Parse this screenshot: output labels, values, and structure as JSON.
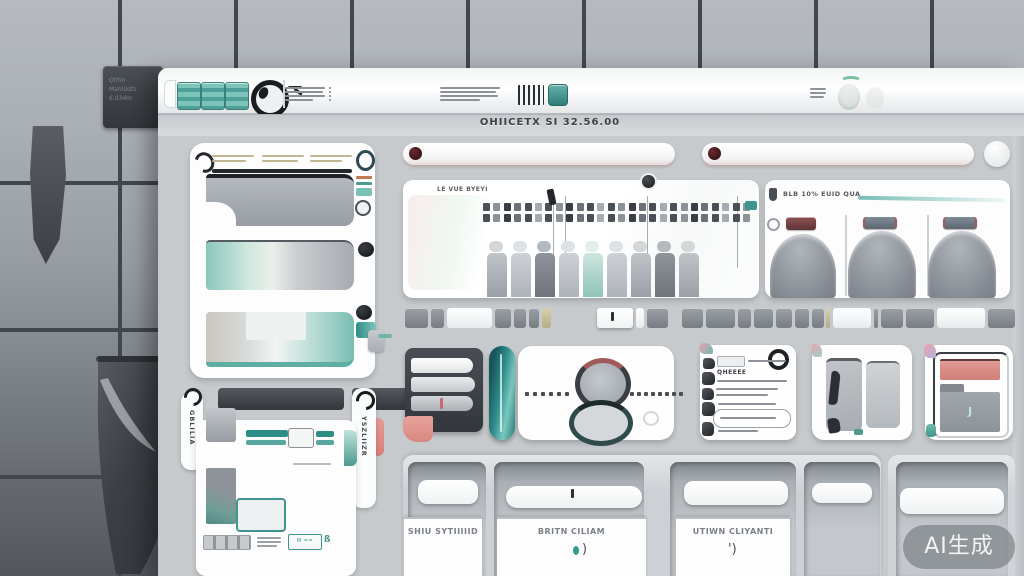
{
  "window": {
    "title": "OHIICETX SI 32.56.00"
  },
  "background": {
    "label_lines": [
      "Qthm",
      "Mahlddts",
      "6.034m"
    ]
  },
  "panels": {
    "timeline": {
      "label": "LE VUE BYEYI"
    },
    "gauges": {
      "label": "BLB 10% EUID QUA"
    },
    "list": {
      "heading": "QHEEEE"
    },
    "dock": {
      "left_tab": "GBLILIA",
      "right_tab": "YSZLIIZR",
      "mini_button": "M =="
    }
  },
  "bottom_cards": [
    {
      "label": "SHIU SYTIIIIID",
      "mark": ""
    },
    {
      "label": "BRITN CILIAM",
      "mark": ")"
    },
    {
      "label": "UTIWN CLIYANTI",
      "mark": "')"
    }
  ],
  "watermark": "AI生成",
  "colors": {
    "teal": "#3f968e",
    "teal_dark": "#2e7d78",
    "salmon": "#e09a94",
    "dark": "#33373c",
    "window_bg": "#c7cacd"
  },
  "deco": {
    "strip": [
      {
        "x": 405,
        "w": 23,
        "t": "d"
      },
      {
        "x": 431,
        "w": 13,
        "t": "d"
      },
      {
        "x": 447,
        "w": 45,
        "t": "w"
      },
      {
        "x": 495,
        "w": 16,
        "t": "d"
      },
      {
        "x": 514,
        "w": 12,
        "t": "d"
      },
      {
        "x": 529,
        "w": 10,
        "t": "d"
      },
      {
        "x": 542,
        "w": 9,
        "t": "y"
      },
      {
        "x": 597,
        "w": 36,
        "t": "r"
      },
      {
        "x": 636,
        "w": 8,
        "t": "w"
      },
      {
        "x": 647,
        "w": 21,
        "t": "d"
      },
      {
        "x": 682,
        "w": 21,
        "t": "d"
      },
      {
        "x": 706,
        "w": 29,
        "t": "d"
      },
      {
        "x": 738,
        "w": 13,
        "t": "d"
      },
      {
        "x": 754,
        "w": 19,
        "t": "d"
      },
      {
        "x": 776,
        "w": 16,
        "t": "d"
      },
      {
        "x": 795,
        "w": 14,
        "t": "d"
      },
      {
        "x": 812,
        "w": 12,
        "t": "d"
      },
      {
        "x": 826,
        "w": 4,
        "t": "y"
      },
      {
        "x": 833,
        "w": 38,
        "t": "w"
      },
      {
        "x": 874,
        "w": 4,
        "t": "d"
      },
      {
        "x": 881,
        "w": 22,
        "t": "d"
      },
      {
        "x": 906,
        "w": 28,
        "t": "d"
      },
      {
        "x": 937,
        "w": 48,
        "t": "w"
      },
      {
        "x": 988,
        "w": 27,
        "t": "d"
      }
    ],
    "ruler": {
      "x": 483,
      "rows": [
        203,
        214
      ],
      "count": 26,
      "pitch": 10.4,
      "w": 7,
      "h": 8
    },
    "hairlines": [
      553,
      565,
      647,
      737
    ],
    "columns": {
      "x": 487,
      "y": 241,
      "pitch": 24,
      "w": 20,
      "styles": [
        "mid",
        "light",
        "dark",
        "light",
        "teal",
        "light",
        "mid",
        "dark",
        "mid"
      ]
    },
    "dots_left": {
      "x": 525,
      "y": 392,
      "count": 6,
      "pitch": 8
    },
    "dots_right": {
      "x": 630,
      "y": 392,
      "count": 8,
      "pitch": 7
    }
  }
}
